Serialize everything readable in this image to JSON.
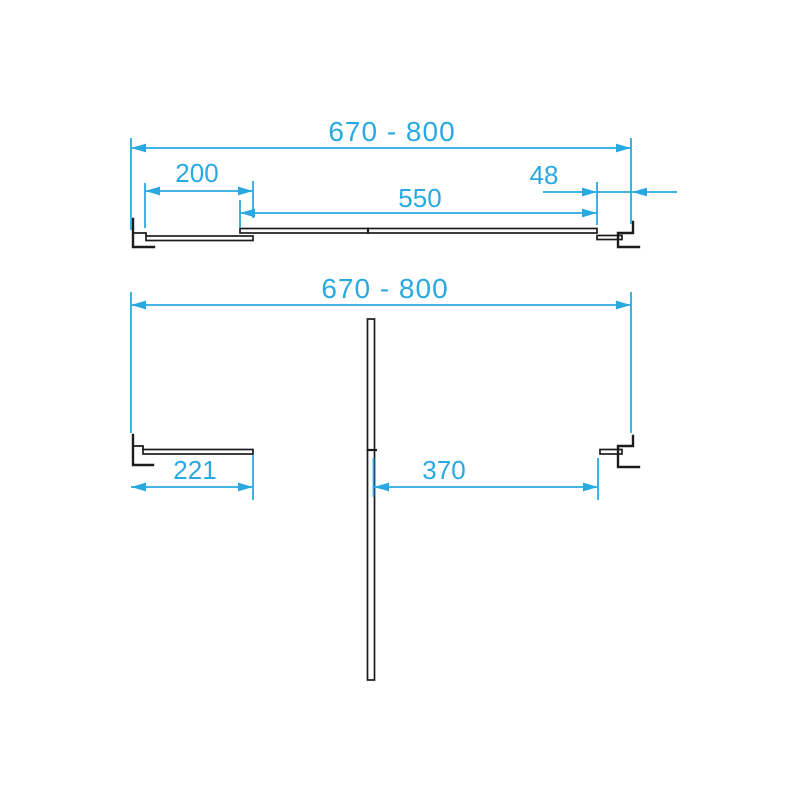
{
  "colors": {
    "dimension": "#29A9E1",
    "profile": "#1C1C1C",
    "background": "#FFFFFF"
  },
  "views": {
    "top": {
      "overall_width": "670 - 800",
      "fixed_panel_width": "200",
      "sliding_panel_width": "550",
      "wall_profile_adjustment": "48"
    },
    "bottom": {
      "overall_width": "670 - 800",
      "fixed_panel_width": "221",
      "door_opening_width": "370"
    }
  }
}
